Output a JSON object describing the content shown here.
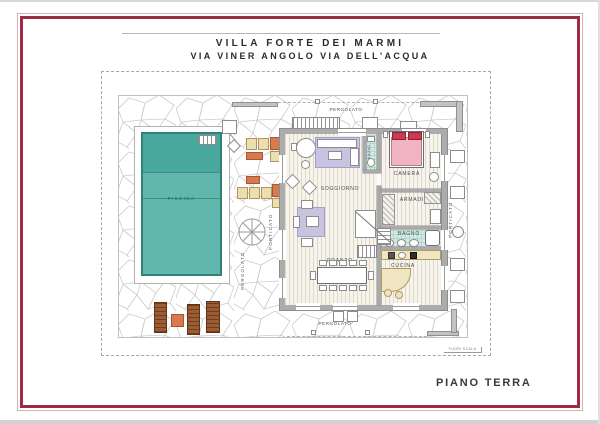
{
  "title": {
    "line1": "VILLA FORTE DEI MARMI",
    "line2": "VIA VINER ANGOLO VIA DELL'ACQUA"
  },
  "rooms": {
    "piscina": "PISCINA",
    "soggiorno": "SOGGIORNO",
    "camera": "CAMERA",
    "armadi": "ARMADI",
    "bagno": "BAGNO",
    "bagno_small": "BAGNO",
    "cucina": "CUCINA",
    "pranzo": "PRANZO"
  },
  "outdoor": {
    "pergolato_top": "PERGOLATO",
    "pergolato_bottom": "PERGOLATO",
    "pergolato_left": "PERGOLATO",
    "porticato_left": "PORTICATO",
    "porticato_right": "PORTICATO"
  },
  "footer": {
    "floor_label": "PIANO TERRA",
    "scale_note": "FUORI SCALA"
  },
  "colors": {
    "frame": "#9d2b43",
    "pool_dark": "#48a89d",
    "pool_light": "#61b7ac",
    "rug": "#c9c3e2",
    "bed": "#f0b4c2",
    "pillow": "#cc3a52",
    "lounger_cream": "#eadfae",
    "lounger_orange": "#d97a4e",
    "lounger_brown": "#9a5c33",
    "kitchen_counter": "#efe5c2",
    "bath_tile": "#d5eae4"
  }
}
